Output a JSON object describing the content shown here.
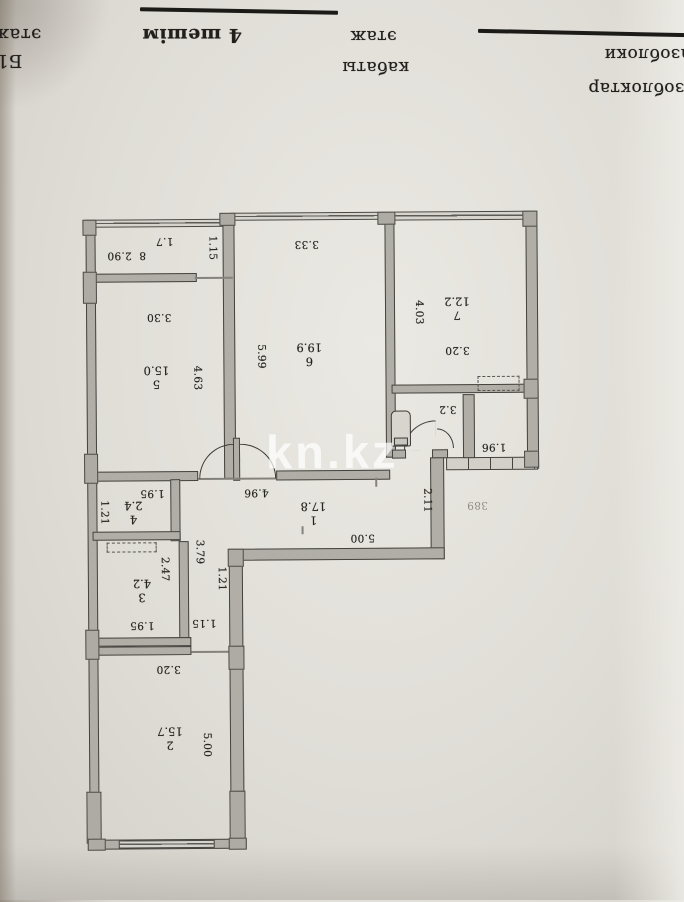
{
  "header": {
    "edge_floor": "этаж",
    "edge_block": "Б1-",
    "variant": "4 шешім",
    "floor_kz": "этаж",
    "floor_kz2": "кабаты",
    "material_ru": "газоблоки",
    "material_kz": "газоблоктар"
  },
  "watermark": "kn.kz",
  "colors": {
    "paper": "#dcd9d3",
    "wall_fill": "#b1aea7",
    "line": "#45433f",
    "ink": "#26241f",
    "watermark": "rgba(255,255,255,0.72)"
  },
  "plan": {
    "rooms": [
      {
        "num": "1",
        "area": "17.8",
        "x": 313,
        "y": 513
      },
      {
        "num": "2",
        "area": "15.7",
        "x": 168,
        "y": 737
      },
      {
        "num": "3",
        "area": "4.2",
        "x": 141,
        "y": 589
      },
      {
        "num": "4",
        "area": "2.4",
        "x": 133,
        "y": 511
      },
      {
        "num": "5",
        "area": "15.0",
        "x": 157,
        "y": 376
      },
      {
        "num": "6",
        "area": "19.9",
        "x": 310,
        "y": 354
      },
      {
        "num": "7",
        "area": "12.2",
        "x": 458,
        "y": 309
      }
    ],
    "dims": [
      {
        "t": "8  2.90",
        "x": 128,
        "y": 254,
        "r": 180
      },
      {
        "t": "1.7",
        "x": 166,
        "y": 240,
        "r": 180
      },
      {
        "t": "1.15",
        "x": 214,
        "y": 247,
        "r": 90
      },
      {
        "t": "3.30",
        "x": 160,
        "y": 316,
        "r": 180
      },
      {
        "t": "4.63",
        "x": 198,
        "y": 377,
        "r": 90
      },
      {
        "t": "5.99",
        "x": 262,
        "y": 356,
        "r": 90
      },
      {
        "t": "3.33",
        "x": 308,
        "y": 244,
        "r": 180
      },
      {
        "t": "4.03",
        "x": 420,
        "y": 313,
        "r": 90
      },
      {
        "t": "3.20",
        "x": 458,
        "y": 351,
        "r": 180
      },
      {
        "t": "3.2",
        "x": 448,
        "y": 410,
        "r": 180
      },
      {
        "t": "1.96",
        "x": 494,
        "y": 448,
        "r": 180
      },
      {
        "t": "2.11",
        "x": 427,
        "y": 501,
        "r": 90
      },
      {
        "t": "389",
        "x": 477,
        "y": 506,
        "r": 180,
        "f": 1
      },
      {
        "t": "4.96",
        "x": 256,
        "y": 492,
        "r": 180
      },
      {
        "t": "5.00",
        "x": 362,
        "y": 538,
        "r": 180
      },
      {
        "t": "1.95",
        "x": 152,
        "y": 492,
        "r": 180
      },
      {
        "t": "1.21",
        "x": 104,
        "y": 511,
        "r": 90
      },
      {
        "t": "2.47",
        "x": 164,
        "y": 568,
        "r": 90
      },
      {
        "t": "3.79",
        "x": 199,
        "y": 551,
        "r": 90
      },
      {
        "t": "1.21",
        "x": 221,
        "y": 578,
        "r": 90
      },
      {
        "t": "1.95",
        "x": 141,
        "y": 624,
        "r": 180
      },
      {
        "t": "1.15",
        "x": 203,
        "y": 622,
        "r": 180
      },
      {
        "t": "3.20",
        "x": 167,
        "y": 668,
        "r": 180
      },
      {
        "t": "5.00",
        "x": 205,
        "y": 744,
        "r": 90
      }
    ]
  }
}
